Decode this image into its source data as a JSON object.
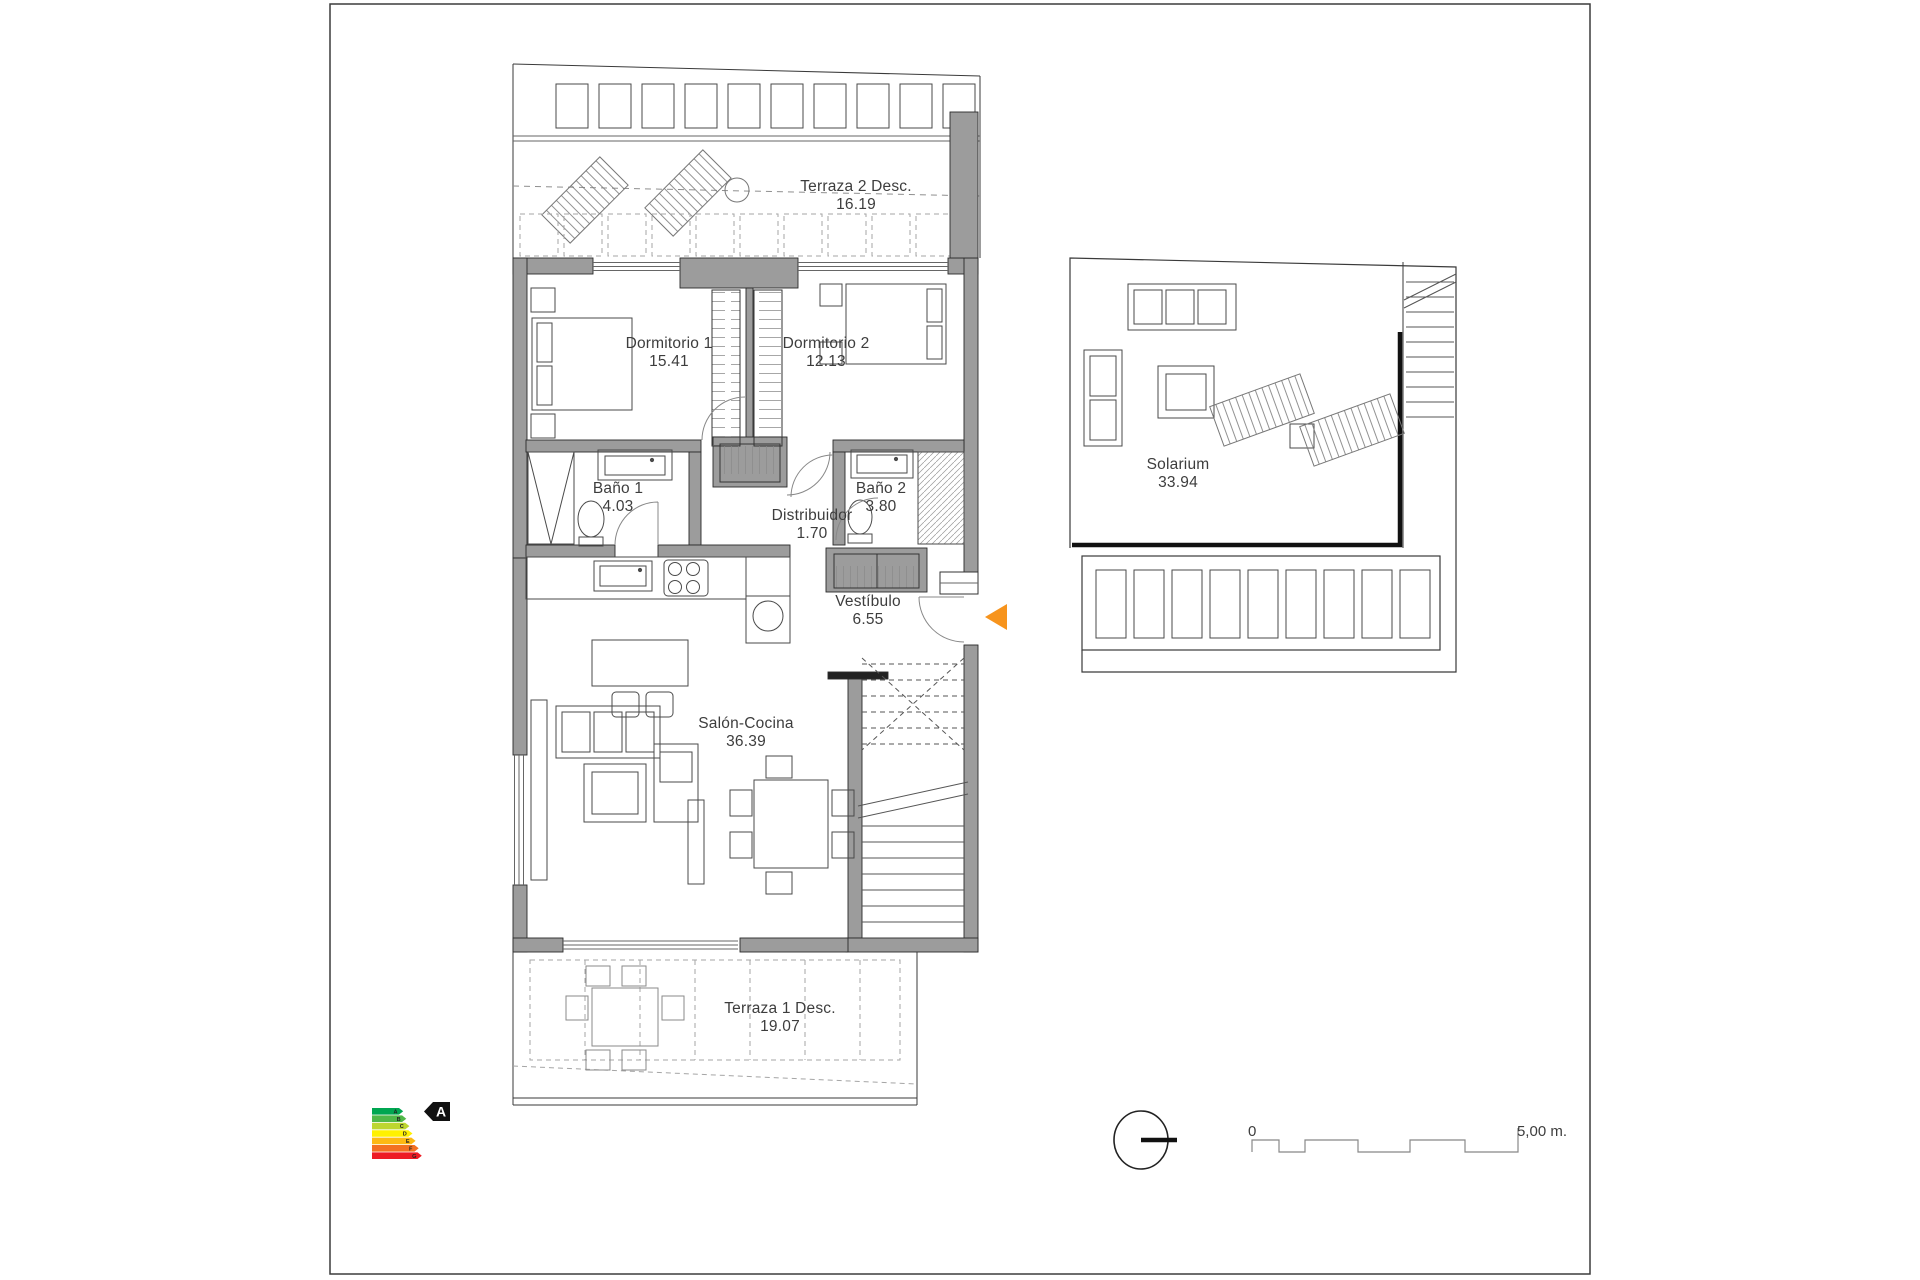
{
  "plan": {
    "rooms": {
      "terraza2": {
        "name": "Terraza 2 Desc.",
        "area": "16.19"
      },
      "dormitorio1": {
        "name": "Dormitorio 1",
        "area": "15.41"
      },
      "dormitorio2": {
        "name": "Dormitorio 2",
        "area": "12.13"
      },
      "bano1": {
        "name": "Baño 1",
        "area": "4.03"
      },
      "bano2": {
        "name": "Baño 2",
        "area": "3.80"
      },
      "distribuidor": {
        "name": "Distribuidor",
        "area": "1.70"
      },
      "vestibulo": {
        "name": "Vestíbulo",
        "area": "6.55"
      },
      "saloncocina": {
        "name": "Salón-Cocina",
        "area": "36.39"
      },
      "terraza1": {
        "name": "Terraza 1 Desc.",
        "area": "19.07"
      },
      "solarium": {
        "name": "Solarium",
        "area": "33.94"
      }
    },
    "colors": {
      "wall_fill": "#9c9c9c",
      "line": "#3a3a3a",
      "dashed_line": "#8f8f8f",
      "text": "#3d3d3d",
      "entrance_arrow": "#f7941d"
    }
  },
  "energy_label": {
    "rating": "A",
    "bands": [
      {
        "letter": "A",
        "color": "#00a651"
      },
      {
        "letter": "B",
        "color": "#50b848"
      },
      {
        "letter": "C",
        "color": "#bdd630"
      },
      {
        "letter": "D",
        "color": "#fff100"
      },
      {
        "letter": "E",
        "color": "#fdb913"
      },
      {
        "letter": "F",
        "color": "#f37021"
      },
      {
        "letter": "G",
        "color": "#ed1c24"
      }
    ]
  },
  "scale_bar": {
    "start_label": "0",
    "end_label": "5,00 m."
  }
}
